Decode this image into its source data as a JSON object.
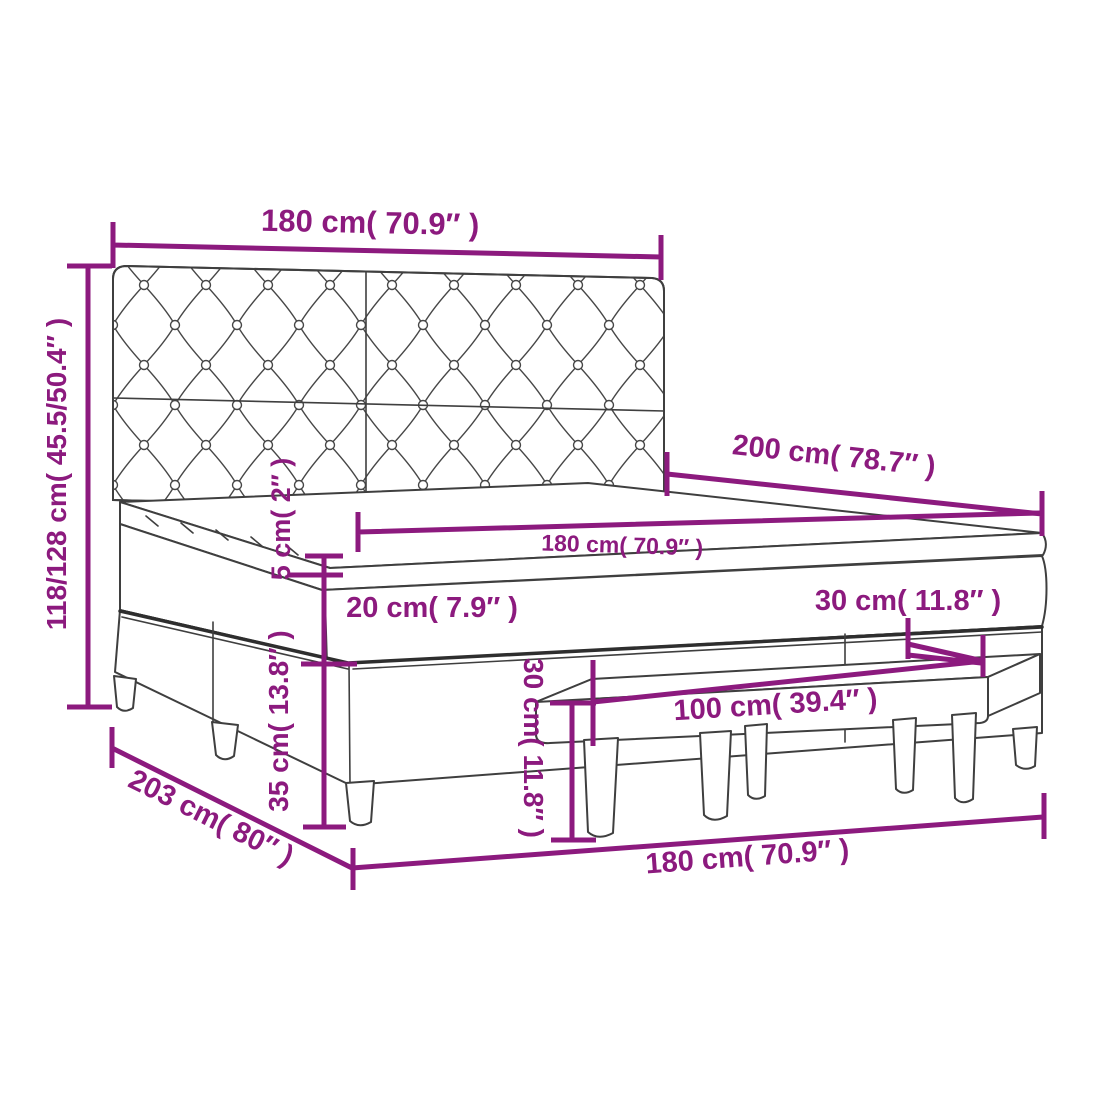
{
  "title": "Box spring bed with headboard and bench – dimension diagram",
  "colors": {
    "dimension_purple": "#8C1A7E",
    "outline_gray": "#3F3F3F",
    "background": "#FFFFFF"
  },
  "dimensions": {
    "headboard_width": {
      "label": "180 cm( 70.9″ )"
    },
    "total_height": {
      "label": "118/128 cm( 45.5/50.4″ )"
    },
    "bed_length": {
      "label": "200 cm( 78.7″ )"
    },
    "mattress_width": {
      "label": "180 cm( 70.9″ )"
    },
    "topper_thickness": {
      "label": "5 cm( 2″ )"
    },
    "mattress_thickness": {
      "label": "20 cm( 7.9″ )"
    },
    "bench_setback": {
      "label": "30 cm( 11.8″ )"
    },
    "bench_height": {
      "label": "30 cm( 11.8″ )"
    },
    "base_height": {
      "label": "35 cm( 13.8″ )"
    },
    "bench_length": {
      "label": "100 cm( 39.4″ )"
    },
    "frame_length": {
      "label": "203 cm( 80″ )"
    },
    "frame_width": {
      "label": "180 cm( 70.9″ )"
    }
  }
}
